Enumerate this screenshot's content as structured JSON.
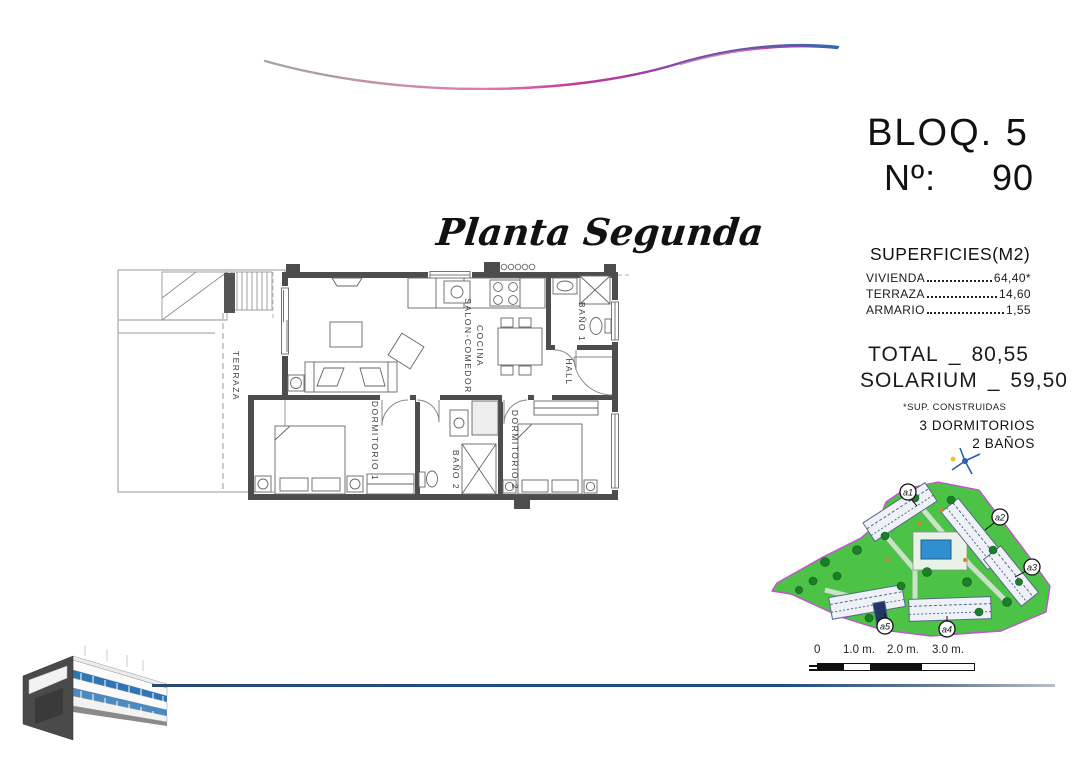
{
  "page": {
    "background": "#ffffff"
  },
  "header": {
    "block": "BLOQ. 5",
    "unit_label": "Nº:",
    "unit_number": "90"
  },
  "plan_title": "Planta Segunda",
  "surfaces": {
    "title": "SUPERFICIES(M2)",
    "rows": [
      {
        "label": "VIVIENDA",
        "value": "64,40*"
      },
      {
        "label": "TERRAZA",
        "value": "14,60"
      },
      {
        "label": "ARMARIO",
        "value": "1,55"
      }
    ],
    "total_label": "TOTAL",
    "total_sep": "_",
    "total_value": "80,55",
    "solarium_label": "SOLARIUM",
    "solarium_sep": "_",
    "solarium_value": "59,50",
    "footnote": "*SUP. CONSTRUIDAS",
    "features": [
      "3 DORMITORIOS",
      "2 BAÑOS"
    ]
  },
  "floor_plan": {
    "rooms": {
      "terraza": "TERRAZA",
      "salon_line1": "SALON-COMEDOR",
      "salon_line2": "COCINA",
      "bano1": "BAÑO 1",
      "hall": "HALL",
      "dormitorio1": "DORMITORIO 1",
      "bano2": "BAÑO 2",
      "dormitorio2": "DORMITORIO 2"
    }
  },
  "site_plan": {
    "labels": {
      "a1": "a1",
      "a2": "a2",
      "a3": "a3",
      "a4": "a4",
      "a5": "a5"
    },
    "colors": {
      "ground": "#4cc247",
      "boundary": "#c94fd2",
      "pool": "#2f8fd0",
      "building_line": "#5a6a85"
    }
  },
  "scale_bar": {
    "labels": [
      "0",
      "1.0 m.",
      "2.0 m.",
      "3.0 m."
    ]
  },
  "decor": {
    "wave_colors": [
      "#9a9a9a",
      "#d96fa8",
      "#8e44ad",
      "#2e6db4"
    ],
    "baseline_color": "#1d4e89",
    "render_window_color": "#2e75b6"
  }
}
